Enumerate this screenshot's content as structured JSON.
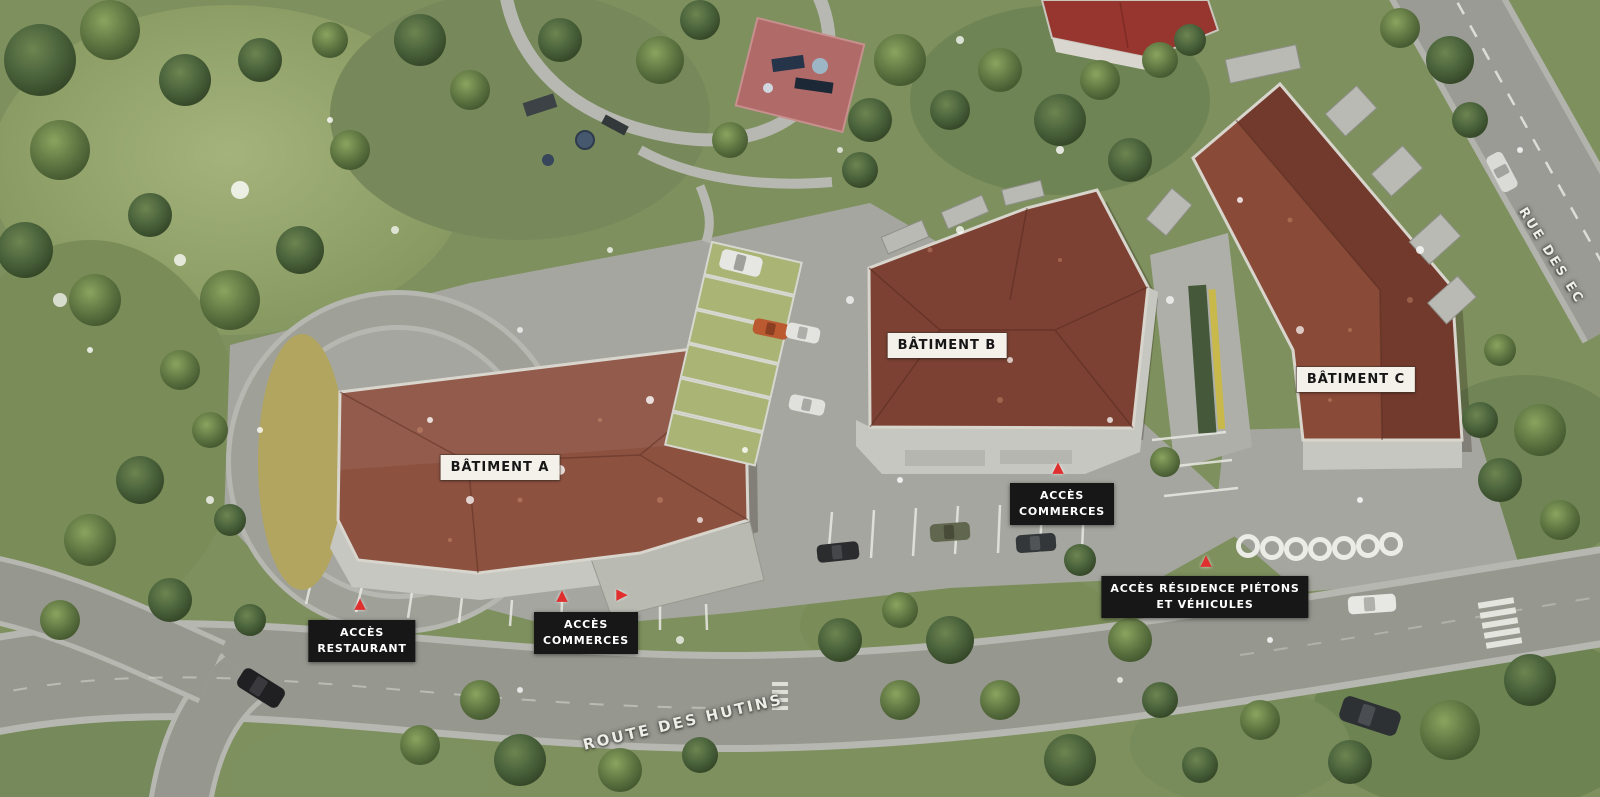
{
  "scene": {
    "description": "Aerial 3D site plan rendering of a residential development with three buildings, access points and surrounding streets",
    "colors": {
      "roof_a": "#8d5140",
      "roof_b": "#7c4133",
      "roof_c_light": "#8a4a38",
      "roof_c_dark": "#723a2c",
      "road": "#96978f",
      "plaza": "#a5a69f",
      "park_green": "#7e905e",
      "building_label_bg": "#f4f1ea",
      "building_label_text": "#161616",
      "access_label_bg": "#171717",
      "access_label_text": "#ffffff",
      "marker_red": "#e02f2f"
    },
    "buildings": [
      {
        "id": "a",
        "label": "BÂTIMENT A"
      },
      {
        "id": "b",
        "label": "BÂTIMENT B"
      },
      {
        "id": "c",
        "label": "BÂTIMENT C"
      }
    ],
    "access_points": [
      {
        "id": "restaurant",
        "line1": "ACCÈS",
        "line2": "RESTAURANT",
        "marker": "▲"
      },
      {
        "id": "commerces-ouest",
        "line1": "ACCÈS",
        "line2": "COMMERCES",
        "marker": "▲",
        "marker_side": "▶"
      },
      {
        "id": "commerces-est",
        "line1": "ACCÈS",
        "line2": "COMMERCES",
        "marker": "▲"
      },
      {
        "id": "residence",
        "line1": "ACCÈS RÉSIDENCE PIÉTONS",
        "line2": "ET VÉHICULES",
        "marker": "▲"
      }
    ],
    "streets": [
      {
        "id": "route-des-hutins",
        "name": "ROUTE DES HUTINS"
      },
      {
        "id": "rue-des-ec",
        "name": "RUE DES EC"
      }
    ]
  }
}
